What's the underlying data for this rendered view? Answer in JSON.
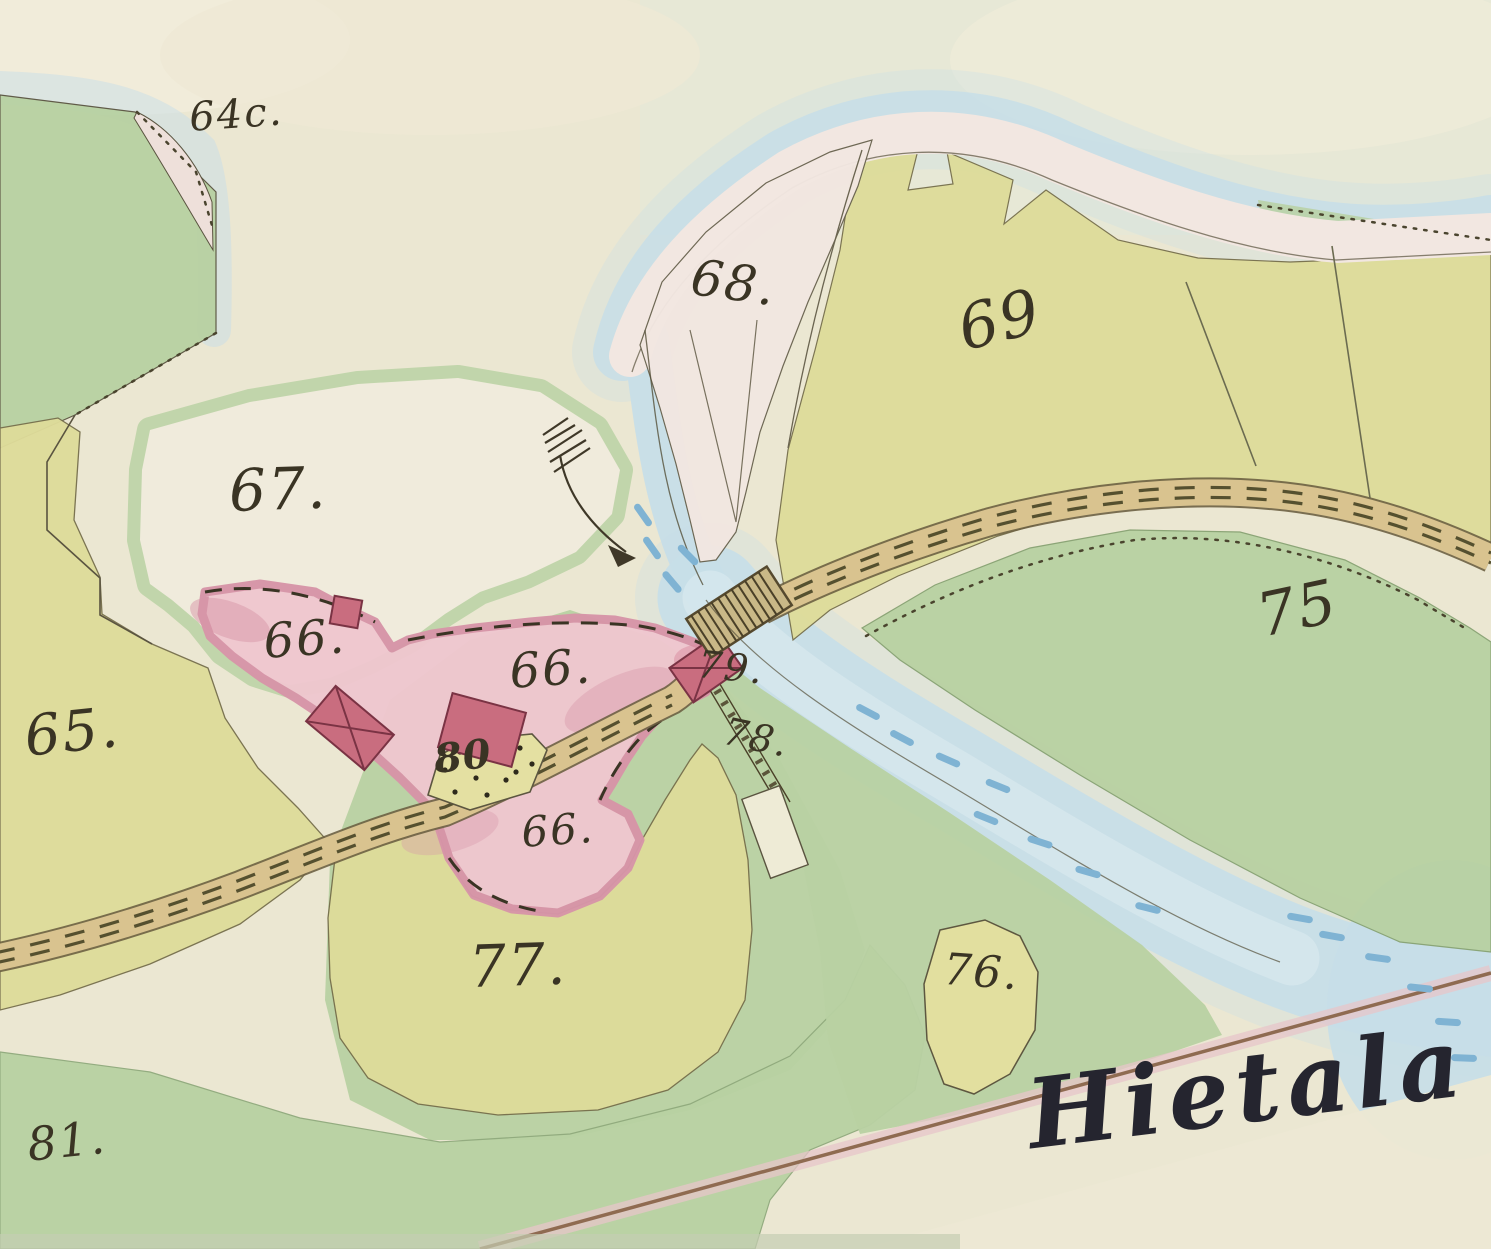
{
  "map": {
    "estate_name": "Hietala",
    "kind": "hand-drawn watercolor cadastral map"
  },
  "palette": {
    "paper": "#ebe7d2",
    "paper_tint": "#e4e9d8",
    "meadow": "#b8d1a2",
    "meadow_ring": "#bdd4a7",
    "field": "#dedc9a",
    "field_pale": "#e2df9f",
    "white_parcel": "#f0ebdc",
    "pink_parcel": "#f2e7e1",
    "farm_pink": "#efc7cf",
    "farm_pink_dark": "#d795a8",
    "building_red": "#c96d7f",
    "water": "#c7dee8",
    "water_light": "#dcebf0",
    "water_dash": "#7fb3d3",
    "road": "#d9c38f",
    "road_edge": "#6d6142",
    "bridge": "#c9b887",
    "ink": "#3a3424",
    "name_ink": "#25252f",
    "boundary": "#5a5440",
    "line_brown": "#8f6b51",
    "line_glow": "#e7c6ca"
  },
  "labels": [
    {
      "id": "label-parcel-64c",
      "text": "64c.",
      "x": 188,
      "y": 98,
      "size": 40,
      "rot": -4
    },
    {
      "id": "label-parcel-67",
      "text": "67.",
      "x": 228,
      "y": 462,
      "size": 58,
      "rot": -2
    },
    {
      "id": "label-parcel-68",
      "text": "68.",
      "x": 695,
      "y": 252,
      "size": 50,
      "rot": 8
    },
    {
      "id": "label-parcel-69",
      "text": "69",
      "x": 952,
      "y": 300,
      "size": 62,
      "rot": -14
    },
    {
      "id": "label-parcel-75",
      "text": "75",
      "x": 1252,
      "y": 588,
      "size": 60,
      "rot": -12
    },
    {
      "id": "label-parcel-65",
      "text": "65.",
      "x": 22,
      "y": 710,
      "size": 56,
      "rot": -6
    },
    {
      "id": "label-parcel-66-west",
      "text": "66.",
      "x": 262,
      "y": 618,
      "size": 48,
      "rot": -4
    },
    {
      "id": "label-parcel-66-main",
      "text": "66.",
      "x": 508,
      "y": 648,
      "size": 48,
      "rot": -4
    },
    {
      "id": "label-parcel-66-south",
      "text": "66.",
      "x": 520,
      "y": 812,
      "size": 42,
      "rot": -4
    },
    {
      "id": "label-plot-80",
      "text": "80",
      "x": 432,
      "y": 740,
      "size": 40,
      "rot": -6,
      "cls": "bold"
    },
    {
      "id": "label-parcel-79",
      "text": "79.",
      "x": 700,
      "y": 645,
      "size": 38,
      "rot": 6
    },
    {
      "id": "label-parcel-78",
      "text": "78.",
      "x": 728,
      "y": 712,
      "size": 38,
      "rot": 12
    },
    {
      "id": "label-parcel-77",
      "text": "77.",
      "x": 468,
      "y": 938,
      "size": 58,
      "rot": -2
    },
    {
      "id": "label-parcel-76",
      "text": "76.",
      "x": 945,
      "y": 948,
      "size": 44,
      "rot": 4
    },
    {
      "id": "label-parcel-81",
      "text": "81.",
      "x": 25,
      "y": 1122,
      "size": 46,
      "rot": -6
    },
    {
      "id": "label-estate-name",
      "text": "Hietala",
      "x": 1022,
      "y": 1068,
      "size": 96,
      "rot": -7,
      "cls": "name"
    }
  ]
}
